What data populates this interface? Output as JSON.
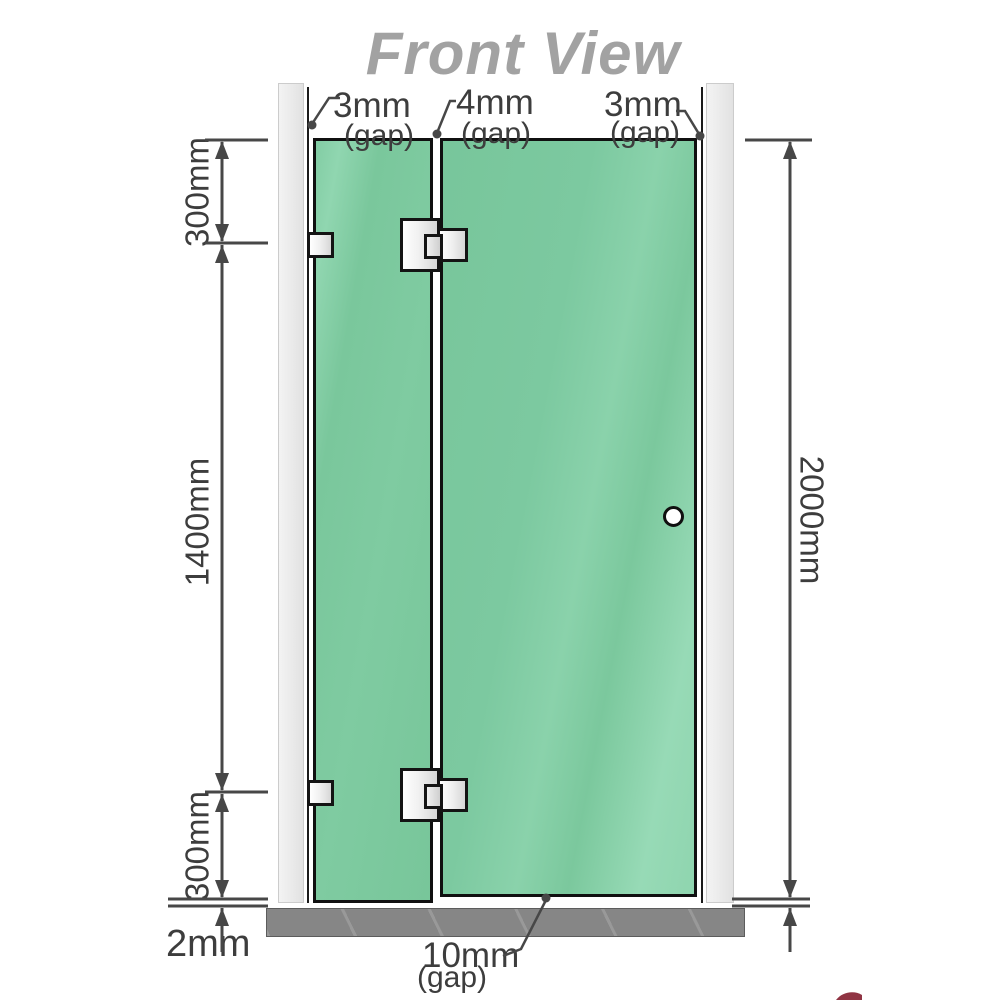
{
  "title": "Front View",
  "colors": {
    "glass": "#7cc9a0",
    "glass_light": "#93d8b3",
    "wall": "#ededed",
    "base": "#868686",
    "outline": "#141414",
    "dim": "#474747",
    "label": "#3d3d3d",
    "title": "#a2a2a2",
    "watermark_red": "#7c1022"
  },
  "gaps": {
    "top_left": {
      "value": "3mm",
      "label": "(gap)"
    },
    "top_middle": {
      "value": "4mm",
      "label": "(gap)"
    },
    "top_right": {
      "value": "3mm",
      "label": "(gap)"
    },
    "bottom": {
      "value": "10mm",
      "label": "(gap)"
    },
    "base": {
      "value": "2mm"
    }
  },
  "dimensions": {
    "upper_segment": "300mm",
    "middle_segment": "1400mm",
    "lower_segment": "300mm",
    "total_height": "2000mm"
  }
}
